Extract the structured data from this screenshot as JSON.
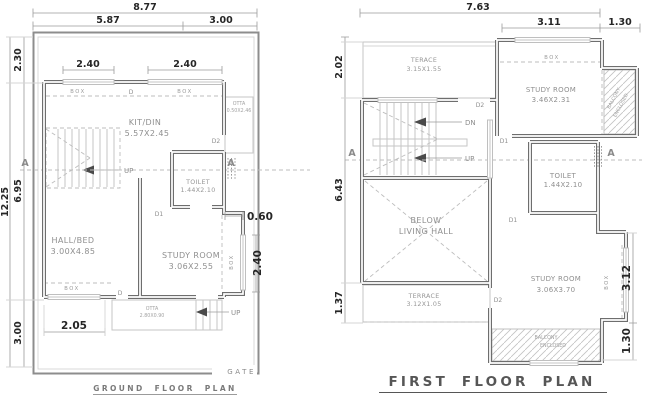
{
  "ground_floor": {
    "title": "GROUND FLOOR PLAN",
    "gate_label": "GATE",
    "dims": {
      "total_width": "8.77",
      "width_left": "5.87",
      "width_right": "3.00",
      "total_depth": "12.25",
      "front_setback": "2.30",
      "building_depth": "6.95",
      "rear_setback": "3.00",
      "window_top_left": "2.40",
      "window_top_right": "2.40",
      "bay_offset": "0.60",
      "bay_window_height": "2.40",
      "window_bottom_left": "2.05"
    },
    "rooms": {
      "kitdin_name": "KIT/DIN",
      "kitdin_size": "5.57X2.45",
      "toilet_name": "TOILET",
      "toilet_size": "1.44X2.10",
      "hallbed_name": "HALL/BED",
      "hallbed_size": "3.00X4.85",
      "study_name": "STUDY ROOM",
      "study_size": "3.06X2.55",
      "otta_side_name": "OTTA",
      "otta_side_size": "0.50X2.46",
      "otta_rear_name": "OTTA",
      "otta_rear_size": "2.80X0.90"
    }
  },
  "first_floor": {
    "title": "FIRST FLOOR PLAN",
    "dims": {
      "total_width": "7.63",
      "study_width": "3.11",
      "balcony_width": "1.30",
      "terrace_depth": "2.02",
      "building_depth": "6.43",
      "rear_terrace_depth": "1.37",
      "bay_window_height": "3.12",
      "balcony_depth": "1.30"
    },
    "rooms": {
      "terrace_top_name": "TERACE",
      "terrace_top_size": "3.15X1.55",
      "study_top_name": "STUDY ROOM",
      "study_top_size": "3.46X2.31",
      "toilet_name": "TOILET",
      "toilet_size": "1.44X2.10",
      "living_line1": "BELOW",
      "living_line2": "LIVING HALL",
      "terrace_rear_name": "TERRACE",
      "terrace_rear_size": "3.12X1.05",
      "study_rear_name": "STUDY ROOM",
      "study_rear_size": "3.06X3.70",
      "balcony_side_line1": "BALCONY",
      "balcony_side_line2": "ENCLOSED",
      "balcony_rear_line1": "BALCONY",
      "balcony_rear_line2": "ENCLOSED"
    }
  },
  "labels": {
    "box": "BOX",
    "up": "UP",
    "down": "DN",
    "door_d": "D",
    "door_d1": "D1",
    "door_d2": "D2",
    "section_marker": "A"
  },
  "colors": {
    "wall": "#6e6e6e",
    "light_line": "#c6c6c6",
    "dimension_line": "#9b9b9b",
    "dimension_text": "#262626",
    "room_text": "#8f8f8f",
    "background": "#ffffff"
  }
}
